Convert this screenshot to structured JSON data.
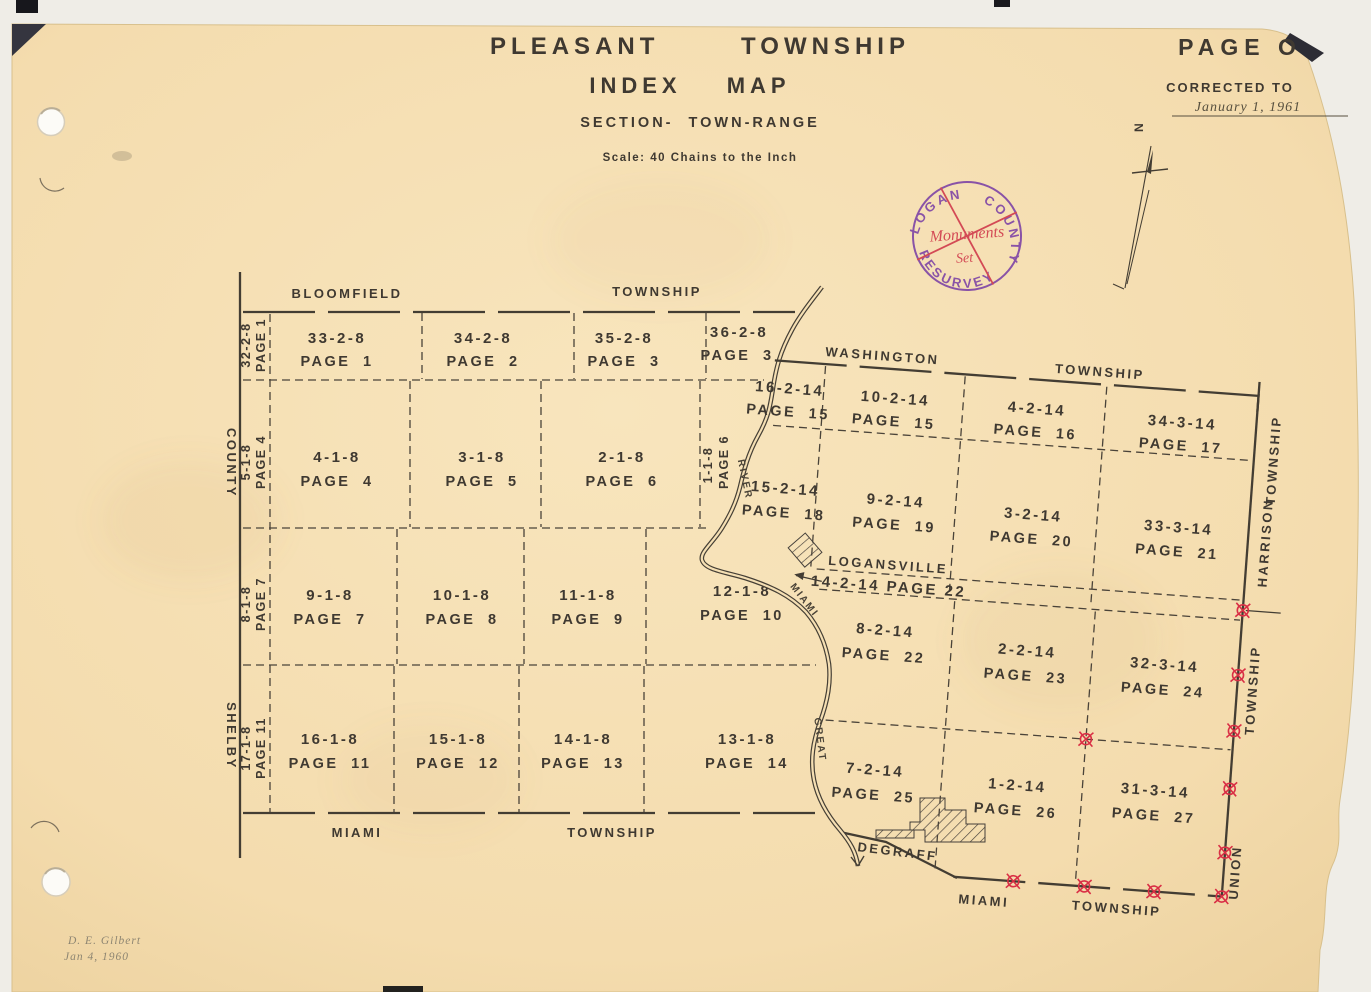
{
  "page": {
    "title_line1": "PLEASANT TOWNSHIP",
    "title_line2": "INDEX MAP",
    "subtitle": "SECTION- TOWN-RANGE",
    "scale_note": "Scale:  40 Chains  to the Inch",
    "page_label": "PAGE O",
    "corrected_to_label": "CORRECTED TO",
    "corrected_to_date": "January 1, 1961",
    "north_label": "N",
    "signature_name": "D. E. Gilbert",
    "signature_date": "Jan 4, 1960"
  },
  "stamp": {
    "arc_top": "LOGAN COUNTY",
    "arc_bottom": "RESURVEY",
    "note_line1": "Monuments",
    "note_line2": "Set"
  },
  "counties": {
    "left_top": "COUNTY",
    "left_bottom": "SHELBY"
  },
  "townships": {
    "bloomfield": "BLOOMFIELD",
    "bloomfield_suffix": "TOWNSHIP",
    "washington": "WASHINGTON",
    "washington_suffix": "TOWNSHIP",
    "miami_left": "MIAMI",
    "miami_left_suffix": "TOWNSHIP",
    "miami_right": "MIAMI",
    "miami_right_suffix": "TOWNSHIP",
    "harrison": "HARRISON",
    "harrison_suffix": "TOWNSHIP",
    "union": "UNION"
  },
  "river": {
    "word_upper": "RIVER",
    "word_middle": "MIAMI",
    "word_lower": "GREAT"
  },
  "places": {
    "logansville": "LOGANSVILLE",
    "degraff": "DEGRAFF"
  },
  "left_grid": {
    "edge_cells": [
      {
        "section": "32-2-8",
        "page": "PAGE 1"
      },
      {
        "section": "5-1-8",
        "page": "PAGE 4"
      },
      {
        "section": "8-1-8",
        "page": "PAGE 7"
      },
      {
        "section": "17-1-8",
        "page": "PAGE 11"
      }
    ],
    "river_cell": {
      "section": "1-1-8",
      "page": "PAGE 6"
    },
    "rows": [
      [
        {
          "section": "33-2-8",
          "page": "PAGE 1"
        },
        {
          "section": "34-2-8",
          "page": "PAGE 2"
        },
        {
          "section": "35-2-8",
          "page": "PAGE 3"
        },
        {
          "section": "36-2-8",
          "page": "PAGE 3"
        }
      ],
      [
        {
          "section": "4-1-8",
          "page": "PAGE 4"
        },
        {
          "section": "3-1-8",
          "page": "PAGE 5"
        },
        {
          "section": "2-1-8",
          "page": "PAGE 6"
        }
      ],
      [
        {
          "section": "9-1-8",
          "page": "PAGE 7"
        },
        {
          "section": "10-1-8",
          "page": "PAGE 8"
        },
        {
          "section": "11-1-8",
          "page": "PAGE 9"
        },
        {
          "section": "12-1-8",
          "page": "PAGE 10"
        }
      ],
      [
        {
          "section": "16-1-8",
          "page": "PAGE 11"
        },
        {
          "section": "15-1-8",
          "page": "PAGE 12"
        },
        {
          "section": "14-1-8",
          "page": "PAGE 13"
        },
        {
          "section": "13-1-8",
          "page": "PAGE 14"
        }
      ]
    ]
  },
  "right_grid": {
    "strip_label": "14-2-14 PAGE 22",
    "rows": [
      [
        {
          "section": "16-2-14",
          "page": "PAGE 15"
        },
        {
          "section": "10-2-14",
          "page": "PAGE 15"
        },
        {
          "section": "4-2-14",
          "page": "PAGE 16"
        },
        {
          "section": "34-3-14",
          "page": "PAGE 17"
        }
      ],
      [
        {
          "section": "15-2-14",
          "page": "PAGE 18"
        },
        {
          "section": "9-2-14",
          "page": "PAGE 19"
        },
        {
          "section": "3-2-14",
          "page": "PAGE 20"
        },
        {
          "section": "33-3-14",
          "page": "PAGE 21"
        }
      ],
      [
        {
          "section": "8-2-14",
          "page": "PAGE 22"
        },
        {
          "section": "2-2-14",
          "page": "PAGE 23"
        },
        {
          "section": "32-3-14",
          "page": "PAGE 24"
        }
      ],
      [
        {
          "section": "7-2-14",
          "page": "PAGE 25"
        },
        {
          "section": "1-2-14",
          "page": "PAGE 26"
        },
        {
          "section": "31-3-14",
          "page": "PAGE 27"
        }
      ]
    ]
  },
  "colors": {
    "paper": "#f5dfb3",
    "ink": "#403a31",
    "monument_red": "#d92f45",
    "stamp_purple": "#7a3fa5",
    "stamp_red": "#cf3548"
  }
}
